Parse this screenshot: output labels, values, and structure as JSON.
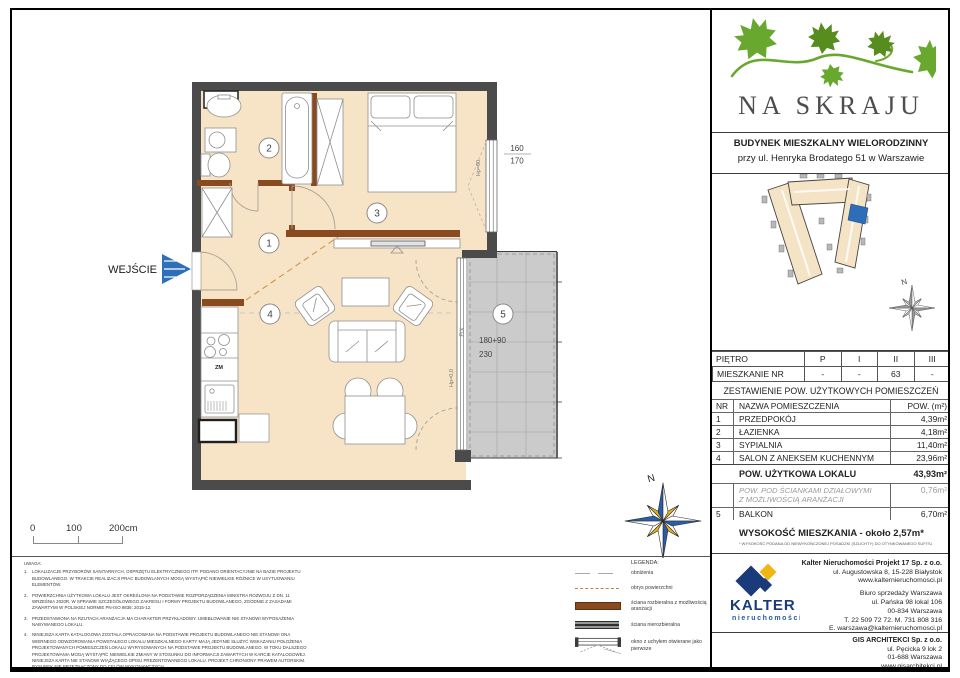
{
  "plan": {
    "entrance_label": "WEJŚCIE",
    "room_numbers": [
      "1",
      "2",
      "3",
      "4",
      "5"
    ],
    "dim_window_top": "160",
    "dim_window_bottom": "170",
    "dim_balcony_width": "180+90",
    "dim_balcony_depth": "230",
    "label_fix": "FIX",
    "label_hp_window": "Hp=60",
    "label_hp_balcony": "Hp=0,0",
    "label_zm": "ZM",
    "compass_n": "N"
  },
  "scale_bar": {
    "tick_0": "0",
    "tick_100": "100",
    "tick_200": "200cm"
  },
  "notes": {
    "title": "UWAGA:",
    "items": [
      {
        "num": "1.",
        "text": "LOKALIZACJE PRZYBORÓW SANITARNYCH, OSPRZĘTU ELEKTRYCZNEGO ITP. PODANO ORIENTACYJNIE NA BAZIE PROJEKTU BUDOWLANEGO. W TRAKCIE REALIZACJI PRAC BUDOWLANYCH MOGĄ WYSTĄPIĆ NIEWIELKIE RÓŻNICE W USYTUOWANIU ELEMENTÓW."
      },
      {
        "num": "2.",
        "text": "POWIERZCHNIA UŻYTKOWA LOKALU JEST OKREŚLONA NA PODSTAWIE ROZPORZĄDZENIA MINISTRA ROZWOJU Z DN. 11 WRZEŚNIA 2020R. W SPRAWIE SZCZEGÓŁOWEGO ZAKRESU I FORMY PROJEKTU BUDOWLANEGO, ZGODNIE Z ZASADAMI ZAWARTYMI W POLSKIEJ NORMIE PN-ISO 9836: 2015-12."
      },
      {
        "num": "3.",
        "text": "PRZEDSTAWIONA NA RZUTACH ARANŻACJA MA CHARAKTER PRZYKŁADOWY. UMEBLOWANIE NIE STANOWI WYPOSAŻENIA NABYWANEGO LOKALU."
      },
      {
        "num": "4.",
        "text": "NINIEJSZA KARTA KATALOGOWA ZOSTAŁA OPRACOWANA NA PODSTAWIE PROJEKTU BUDOWLANEGO NIE STANOWI ONA WIERNEGO ODWZOROWANIA POWSTAŁEGO LOKALU MIESZKALNEGO KARTY MAJĄ JEDYNIE SŁUŻYĆ WSKAZANIU POŁOŻENIA PROJEKTOWANYCH POMIESZCZEŃ LOKALU WYRYSOWANYCH NA PODSTAWIE PROJEKTU BUDOWLANEGO. W TOKU DALSZEGO PROJEKTOWANIA MOGĄ WYSTĄPIĆ NIEWIELKIE ZMIANY W STOSUNKU DO INFORMACJI ZAWARTYCH W KARCIE KATALOGOWEJ. NINIEJSZA KARTA NIE STANOWI  WIĄŻĄCEGO OPISU PREZENTOWANEGO LOKALU. PROJEKT CHRONIONY PRAWEM AUTORSKIM. RYSUNEK NIE PRZEZNACZONY DO CELÓW WYKONAWCZYCH."
      }
    ]
  },
  "legend": {
    "title": "LEGENDA:",
    "items": [
      {
        "label": "obniżenia"
      },
      {
        "label": "obrys powierzchni"
      },
      {
        "label": "ściana rozbieralna z możliwością aranżacji"
      },
      {
        "label": "ściana nierozbieralna"
      },
      {
        "label": "okno z uchyłem otwierane jako pierwsze"
      }
    ]
  },
  "panel": {
    "logo_title": "NA SKRAJU",
    "building_line1": "BUDYNEK MIESZKALNY WIELORODZINNY",
    "building_line2": "przy ul. Henryka Brodatego 51 w Warszawie",
    "floor_row_label": "PIĘTRO",
    "floor_cols": [
      "P",
      "I",
      "II",
      "III"
    ],
    "apt_row_label": "MIESZKANIE NR",
    "apt_cols": [
      "-",
      "-",
      "63",
      "-"
    ],
    "table_title": "ZESTAWIENIE POW. UŻYTKOWYCH POMIESZCZEŃ",
    "col_nr": "NR",
    "col_name": "NAZWA POMIESZCZENIA",
    "col_area": "POW. (m²)",
    "rooms": [
      {
        "nr": "1",
        "name": "PRZEDPOKÓJ",
        "area": "4,39m²"
      },
      {
        "nr": "2",
        "name": "ŁAZIENKA",
        "area": "4,18m²"
      },
      {
        "nr": "3",
        "name": "SYPIALNIA",
        "area": "11,40m²"
      },
      {
        "nr": "4",
        "name": "SALON Z ANEKSEM KUCHENNYM",
        "area": "23,96m²"
      }
    ],
    "total_label": "POW. UŻYTKOWA LOKALU",
    "total_area": "43,93m²",
    "partition_line1": "POW. POD ŚCIANKAMI DZIAŁOWYMI",
    "partition_line2": "Z MOŻLIWOŚCIĄ ARANŻACJI",
    "partition_area": "0,76m²",
    "balcony_nr": "5",
    "balcony_name": "BALKON",
    "balcony_area": "6,70m²",
    "height_text": "WYSOKOŚĆ MIESZKANIA - około 2,57m*",
    "height_footnote": "* WYSOKOŚĆ PODANA OD NIEWYKOŃCZONEJ POSADZKI (SZLICHTY) DO OTYNKOWANEGO SUFITU",
    "kalter_wordmark": "KALTER",
    "kalter_sub": "nieruchomości",
    "kalter_company": "Kalter Nieruchomości Projekt 17 Sp. z o.o.",
    "kalter_addr1": "ul. Augustowska 8, 15-228 Białystok",
    "kalter_web": "www.kalternieruchomosci.pl",
    "kalter_office": "Biuro sprzedaży Warszawa",
    "kalter_addr2": "ul. Pańska 98 lokal 106",
    "kalter_addr3": "00-834 Warszawa",
    "kalter_phone": "T. 22 509 72 72. M. 731 808 316",
    "kalter_email": "E. warszawa@kalternieruchomosci.pl",
    "gis_company": "GIS ARCHITEKCI Sp. z o.o.",
    "gis_addr1": "ul. Pęcicka 9 lok 2",
    "gis_addr2": "01-688 Warszawa",
    "gis_web": "www.gisarchitekci.pl"
  },
  "colors": {
    "accent_blue": "#2f6fb7",
    "wall_dark": "#4b4b4b",
    "wall_brown": "#8a4a20",
    "floor_beige": "#f7e4c6",
    "logo_green": "#69a82f",
    "kalter_navy": "#1b3a7a",
    "kalter_yellow": "#f2b613"
  }
}
